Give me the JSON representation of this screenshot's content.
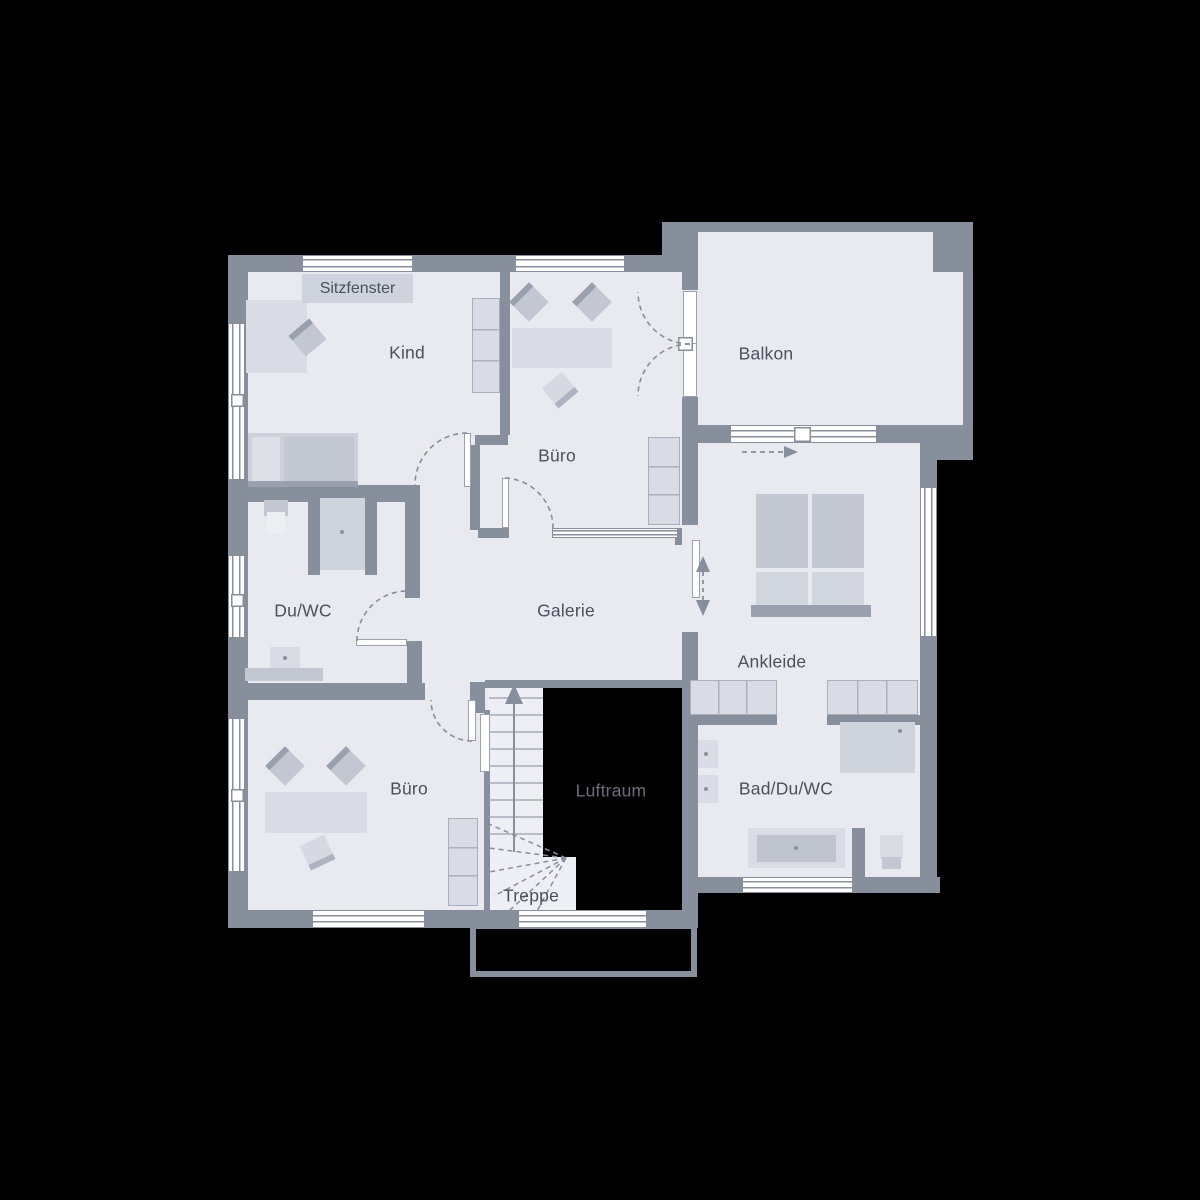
{
  "plan": {
    "type": "floor-plan",
    "labels": {
      "sitzfenster": "Sitzfenster",
      "kind": "Kind",
      "buero_oben": "Büro",
      "balkon": "Balkon",
      "du_wc": "Du/WC",
      "galerie": "Galerie",
      "ankleide": "Ankleide",
      "buero_unten": "Büro",
      "bad_du_wc": "Bad/Du/WC",
      "luftraum": "Luftraum",
      "treppe": "Treppe"
    },
    "colors": {
      "background": "#000000",
      "wall": "#878e9c",
      "floor": "#e8eaf0",
      "window": "#ffffff",
      "furniture_light": "#d9dce4",
      "furniture_medium": "#c3c7d2",
      "furniture_dark": "#9aa0ae",
      "label_text": "#4b505c",
      "luftraum_text": "#686e79",
      "luftraum_fill": "#000000"
    },
    "icons": {
      "stairs_up_arrow": "▲",
      "slide_arrow_right": "▶",
      "slide_arrow_vertical": "↕"
    }
  }
}
